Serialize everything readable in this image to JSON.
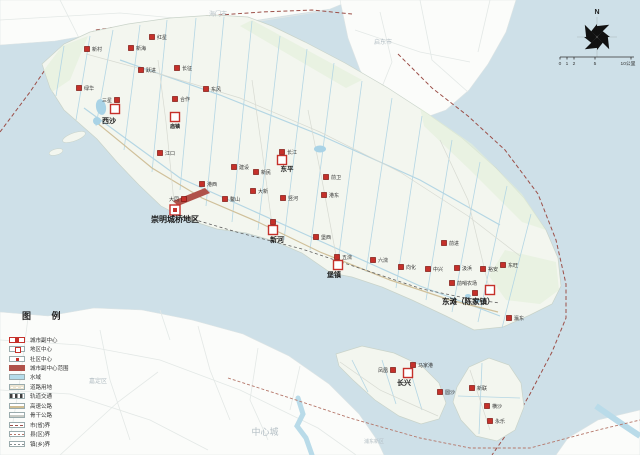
{
  "legend": {
    "title": "图  例",
    "items": [
      {
        "key": "subcenter",
        "label": "城市副中心"
      },
      {
        "key": "district",
        "label": "地区中心"
      },
      {
        "key": "community",
        "label": "社区中心"
      },
      {
        "key": "area",
        "label": "城市副中心范围"
      },
      {
        "key": "water",
        "label": "水域"
      },
      {
        "key": "roadland",
        "label": "道路用地"
      },
      {
        "key": "rail",
        "label": "轨道交通"
      },
      {
        "key": "highway",
        "label": "高速公路"
      },
      {
        "key": "trunk",
        "label": "骨干公路"
      },
      {
        "key": "bprov",
        "label": "市(省)界"
      },
      {
        "key": "bcounty",
        "label": "县(区)界"
      },
      {
        "key": "btown",
        "label": "镇(乡)界"
      }
    ]
  },
  "compass": {
    "n": "N",
    "cx": 597,
    "cy": 37,
    "r": 20,
    "nx": 597,
    "ny": 14
  },
  "scalebar": {
    "y": 57,
    "x1": 560,
    "x2": 634,
    "ticks": [
      560,
      567,
      574,
      595,
      631
    ],
    "labels": [
      {
        "t": "0",
        "x": 560
      },
      {
        "t": "1",
        "x": 567
      },
      {
        "t": "2",
        "x": 574
      },
      {
        "t": "5",
        "x": 595
      },
      {
        "t": "10公里",
        "x": 628
      }
    ]
  },
  "background_labels": [
    {
      "t": "海门市",
      "x": 218,
      "y": 16,
      "s": 6
    },
    {
      "t": "启东市",
      "x": 383,
      "y": 44,
      "s": 6
    },
    {
      "t": "嘉定区",
      "x": 98,
      "y": 383,
      "s": 6
    },
    {
      "t": "中心城",
      "x": 265,
      "y": 435,
      "s": 9
    },
    {
      "t": "浦东新区",
      "x": 374,
      "y": 443,
      "s": 5
    }
  ],
  "city_subcenter": {
    "x": 175,
    "y": 210,
    "label": "崇明城桥地区",
    "lx": 151,
    "ly": 222,
    "ls": 8,
    "anchor": "start"
  },
  "district_centers": [
    {
      "x": 115,
      "y": 109,
      "label": "西沙",
      "lx": 109,
      "ly": 123,
      "ls": 7,
      "anchor": "middle"
    },
    {
      "x": 175,
      "y": 117,
      "label": "庙镇",
      "lx": 175,
      "ly": 128,
      "ls": 5,
      "anchor": "middle"
    },
    {
      "x": 282,
      "y": 160,
      "label": "东平",
      "lx": 287,
      "ly": 171,
      "ls": 6.5,
      "anchor": "middle"
    },
    {
      "x": 273,
      "y": 230,
      "label": "新河",
      "lx": 277,
      "ly": 242,
      "ls": 7,
      "anchor": "middle"
    },
    {
      "x": 338,
      "y": 265,
      "label": "堡镇",
      "lx": 334,
      "ly": 277,
      "ls": 7,
      "anchor": "middle"
    },
    {
      "x": 490,
      "y": 290,
      "label": "东滩（陈家镇）",
      "lx": 442,
      "ly": 304,
      "ls": 7.5,
      "anchor": "start"
    },
    {
      "x": 408,
      "y": 373,
      "label": "长兴",
      "lx": 404,
      "ly": 385,
      "ls": 7,
      "anchor": "middle"
    }
  ],
  "community_centers": [
    {
      "x": 87,
      "y": 49,
      "label": "新村",
      "side": "r"
    },
    {
      "x": 131,
      "y": 48,
      "label": "新海",
      "side": "r"
    },
    {
      "x": 152,
      "y": 37,
      "label": "红星",
      "side": "r"
    },
    {
      "x": 141,
      "y": 70,
      "label": "跃进",
      "side": "r"
    },
    {
      "x": 177,
      "y": 68,
      "label": "长征",
      "side": "r"
    },
    {
      "x": 206,
      "y": 89,
      "label": "东风",
      "side": "r"
    },
    {
      "x": 79,
      "y": 88,
      "label": "绿华",
      "side": "r"
    },
    {
      "x": 117,
      "y": 100,
      "label": "三星",
      "side": "l"
    },
    {
      "x": 175,
      "y": 99,
      "label": "合作",
      "side": "r"
    },
    {
      "x": 160,
      "y": 153,
      "label": "江口",
      "side": "r"
    },
    {
      "x": 202,
      "y": 184,
      "label": "港西",
      "side": "r"
    },
    {
      "x": 184,
      "y": 199,
      "label": "大同",
      "side": "l"
    },
    {
      "x": 225,
      "y": 199,
      "label": "鳌山",
      "side": "r"
    },
    {
      "x": 234,
      "y": 167,
      "label": "建设",
      "side": "r"
    },
    {
      "x": 256,
      "y": 172,
      "label": "新民",
      "side": "r"
    },
    {
      "x": 253,
      "y": 191,
      "label": "大新",
      "side": "r"
    },
    {
      "x": 283,
      "y": 198,
      "label": "竖河",
      "side": "r"
    },
    {
      "x": 282,
      "y": 152,
      "label": "长江",
      "side": "r"
    },
    {
      "x": 326,
      "y": 177,
      "label": "前卫",
      "side": "r"
    },
    {
      "x": 324,
      "y": 195,
      "label": "港东",
      "side": "r"
    },
    {
      "x": 273,
      "y": 222,
      "label": "",
      "side": "r"
    },
    {
      "x": 316,
      "y": 237,
      "label": "堡西",
      "side": "r"
    },
    {
      "x": 337,
      "y": 257,
      "label": "五滧",
      "side": "r"
    },
    {
      "x": 373,
      "y": 260,
      "label": "六滧",
      "side": "r"
    },
    {
      "x": 401,
      "y": 267,
      "label": "向化",
      "side": "r"
    },
    {
      "x": 428,
      "y": 269,
      "label": "中兴",
      "side": "r"
    },
    {
      "x": 457,
      "y": 268,
      "label": "汲浜",
      "side": "r"
    },
    {
      "x": 444,
      "y": 243,
      "label": "前进",
      "side": "r"
    },
    {
      "x": 452,
      "y": 283,
      "label": "前哨农场",
      "side": "r"
    },
    {
      "x": 483,
      "y": 269,
      "label": "裕安",
      "side": "r"
    },
    {
      "x": 503,
      "y": 265,
      "label": "东旺",
      "side": "r"
    },
    {
      "x": 475,
      "y": 293,
      "label": "",
      "side": "l"
    },
    {
      "x": 509,
      "y": 318,
      "label": "瀛东",
      "side": "r"
    },
    {
      "x": 393,
      "y": 370,
      "label": "凤凰",
      "side": "l"
    },
    {
      "x": 413,
      "y": 365,
      "label": "马家港",
      "side": "r"
    },
    {
      "x": 440,
      "y": 392,
      "label": "圆沙",
      "side": "r"
    },
    {
      "x": 472,
      "y": 388,
      "label": "新联",
      "side": "r"
    },
    {
      "x": 487,
      "y": 406,
      "label": "横沙",
      "side": "r"
    },
    {
      "x": 490,
      "y": 421,
      "label": "永乐",
      "side": "r"
    }
  ],
  "colors": {
    "water": "#cee0e8",
    "land": "#fbfcfa",
    "land_stroke": "#dde4e4",
    "island": "#f3f6ef",
    "island_stroke": "#c9d3c9",
    "green": "#e4efda",
    "canal": "#b4d6e4",
    "lake": "#a9d3e6",
    "road_tan": "#d0c09a",
    "road_grey": "#d7dad2",
    "rail": "#5f5f5f",
    "mainland_road": "#e3e8e6",
    "river": "#b9dbe9",
    "marker_fill": "#c5302a",
    "marker_stroke": "#7e1410",
    "area_fill": "#b0524a",
    "bprov": "#9c4f48",
    "bcounty": "#b5776a",
    "bg_text": "#b3bec4",
    "label_text": "#333333",
    "big_label": "#1a1a1a"
  },
  "geo": {
    "island": "M42,64 L64,44 L90,32 L128,24 L170,18 L215,15 L248,17 L272,26 L305,42 L345,63 L388,88 L428,114 L462,138 L496,168 L524,198 L546,230 L558,258 L561,286 L552,304 L530,315 L503,327 L474,330 L446,316 L412,300 L382,287 L352,277 L331,273 L302,253 L274,241 L246,233 L217,229 L186,219 L161,206 L139,185 L117,162 L97,139 L80,124 L64,110 L50,88 Z",
    "changxing": "M336,354 L362,346 L394,353 L422,366 L439,383 L446,403 L439,419 L421,424 L399,416 L375,400 L353,380 L339,366 Z",
    "hengsha": "M457,387 L469,367 L489,358 L509,365 L521,383 L524,407 L515,430 L497,441 L476,436 L461,420 L453,402 Z",
    "mainland_north": "M0,0 L352,0 L330,9 L290,15 L252,21 L215,29 L175,28 L135,30 L95,34 L55,41 L0,45 Z",
    "qidong": "M340,0 L516,0 L506,32 L488,64 L469,90 L446,110 L421,119 L398,117 L377,99 L360,70 L348,38 Z",
    "mainland_sw": "M0,312 L48,316 L94,308 L142,310 L192,320 L243,334 L289,356 L329,384 L359,414 L377,440 L384,455 L0,455 Z",
    "corner_se": "M556,455 L640,455 L640,410 L598,420 L568,438 Z",
    "green_zones": [
      "252,20 362,80 346,88 240,26",
      "420,108 472,144 522,194 546,230 522,222 470,170 424,126",
      "505,250 556,262 559,290 540,304 506,300 489,276",
      "44,70 62,46 88,36 70,80 52,92"
    ],
    "islets": [
      {
        "cx": 74,
        "cy": 137,
        "rx": 12,
        "ry": 4,
        "rot": -20
      },
      {
        "cx": 56,
        "cy": 152,
        "rx": 7,
        "ry": 3,
        "rot": -15
      }
    ],
    "lakes": [
      {
        "cx": 101,
        "cy": 107,
        "rx": 5,
        "ry": 8,
        "rot": -10
      },
      {
        "cx": 97,
        "cy": 121,
        "rx": 4,
        "ry": 4,
        "rot": 0
      },
      {
        "cx": 320,
        "cy": 149,
        "rx": 6,
        "ry": 3.5,
        "rot": 0
      },
      {
        "cx": 468,
        "cy": 296,
        "rx": 3,
        "ry": 2,
        "rot": 0
      },
      {
        "cx": 477,
        "cy": 301,
        "rx": 3,
        "ry": 2,
        "rot": 0
      }
    ],
    "canals": [
      [
        113,
        30,
        96,
        126
      ],
      [
        140,
        25,
        124,
        150
      ],
      [
        167,
        20,
        152,
        172
      ],
      [
        196,
        18,
        180,
        190
      ],
      [
        224,
        17,
        206,
        206
      ],
      [
        252,
        21,
        232,
        222
      ],
      [
        280,
        36,
        258,
        230
      ],
      [
        307,
        49,
        284,
        240
      ],
      [
        334,
        63,
        310,
        250
      ],
      [
        362,
        81,
        338,
        262
      ],
      [
        392,
        98,
        366,
        272
      ],
      [
        422,
        116,
        396,
        288
      ],
      [
        452,
        140,
        426,
        300
      ],
      [
        480,
        162,
        452,
        312
      ],
      [
        507,
        186,
        478,
        322
      ],
      [
        531,
        214,
        502,
        328
      ],
      [
        90,
        36,
        76,
        120
      ],
      [
        64,
        46,
        56,
        96
      ],
      [
        352,
        360,
        368,
        392
      ],
      [
        382,
        360,
        396,
        404
      ],
      [
        410,
        370,
        422,
        410
      ],
      [
        482,
        363,
        479,
        434
      ],
      [
        458,
        396,
        520,
        398
      ]
    ],
    "rivers": [
      "84,108 180,178 300,232 420,286 500,316",
      "120,60 220,95 320,135 420,180 500,225"
    ],
    "roads_tan": [
      "96,122 152,168 202,198 258,222 320,252 390,280 450,300 498,312"
    ],
    "roads_grey": [
      "86,54 160,74 240,98 320,132 400,172 468,216 520,256",
      "175,212 166,122 158,60",
      "273,232 262,150 252,80",
      "338,266 322,180 308,110",
      "490,292 468,200 440,140",
      "340,362 380,390 420,408 438,416",
      "470,370 480,400 490,430"
    ],
    "rail": "172,213 240,233 302,249 362,269 422,289 470,299 500,303",
    "boundary_province": [
      "0,132 30,92 57,52 96,30 150,22 205,16 262,12 312,10 352,14",
      "398,54 432,88 468,116 505,150 538,194 556,240 566,284 566,318 552,352 530,394 508,432 492,455"
    ],
    "boundary_county": [
      "228,378 290,398 350,418 420,438 470,448 530,448 598,430 640,420"
    ],
    "mainland_roads": [
      "0,20 120,13 240,24 330,10",
      "60,0 80,40",
      "355,30 420,52 470,62",
      "380,12 392,62 372,112",
      "420,0 432,60 468,92",
      "490,0 478,52",
      "0,340 80,345 160,360 240,390 318,428 356,455",
      "60,455 118,402 158,372",
      "0,390 70,394 150,420 208,450",
      "100,330 110,380 130,440",
      "198,326 210,370 230,420",
      "28,318 20,380 10,440",
      "258,348 250,400 268,440",
      "300,366 290,410",
      "160,310 170,340"
    ],
    "huangpu": "298,398 303,414 297,426 306,438 312,455",
    "se_river": "596,406 622,424 640,436",
    "subcenter_area": "173,201 205,188 210,193 178,206"
  }
}
